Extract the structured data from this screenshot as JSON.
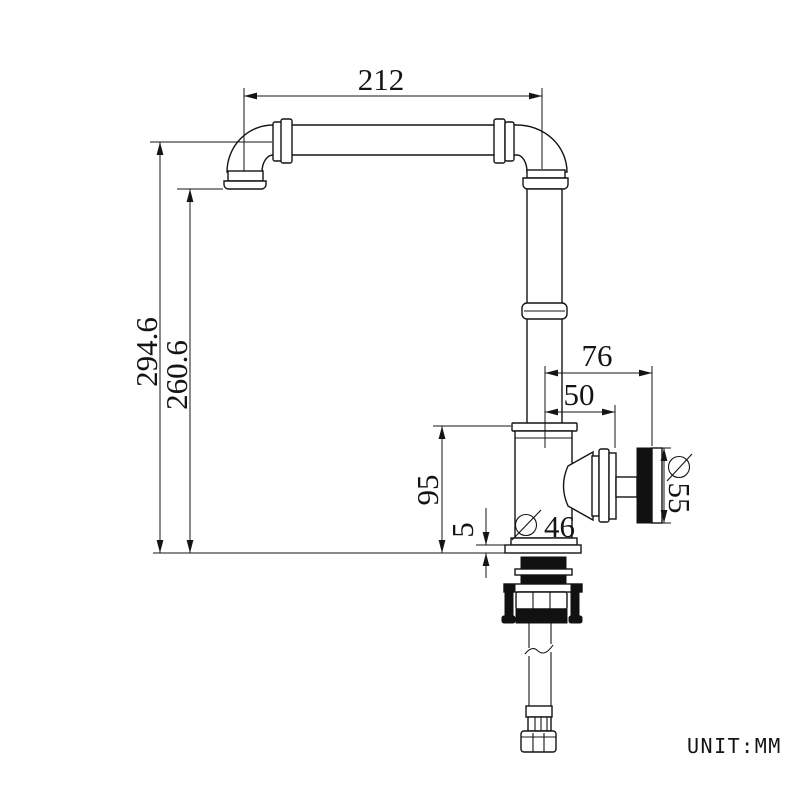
{
  "drawing": {
    "unit_label": "UNIT:MM",
    "dims": {
      "spout_reach": "212",
      "height_total": "294.6",
      "height_to_outlet": "260.6",
      "knob_face_offset": "76",
      "knob_base_offset": "50",
      "body_height": "95",
      "base_plate_thickness": "5",
      "body_diameter_value": "46",
      "knob_diameter_value": "55"
    }
  }
}
